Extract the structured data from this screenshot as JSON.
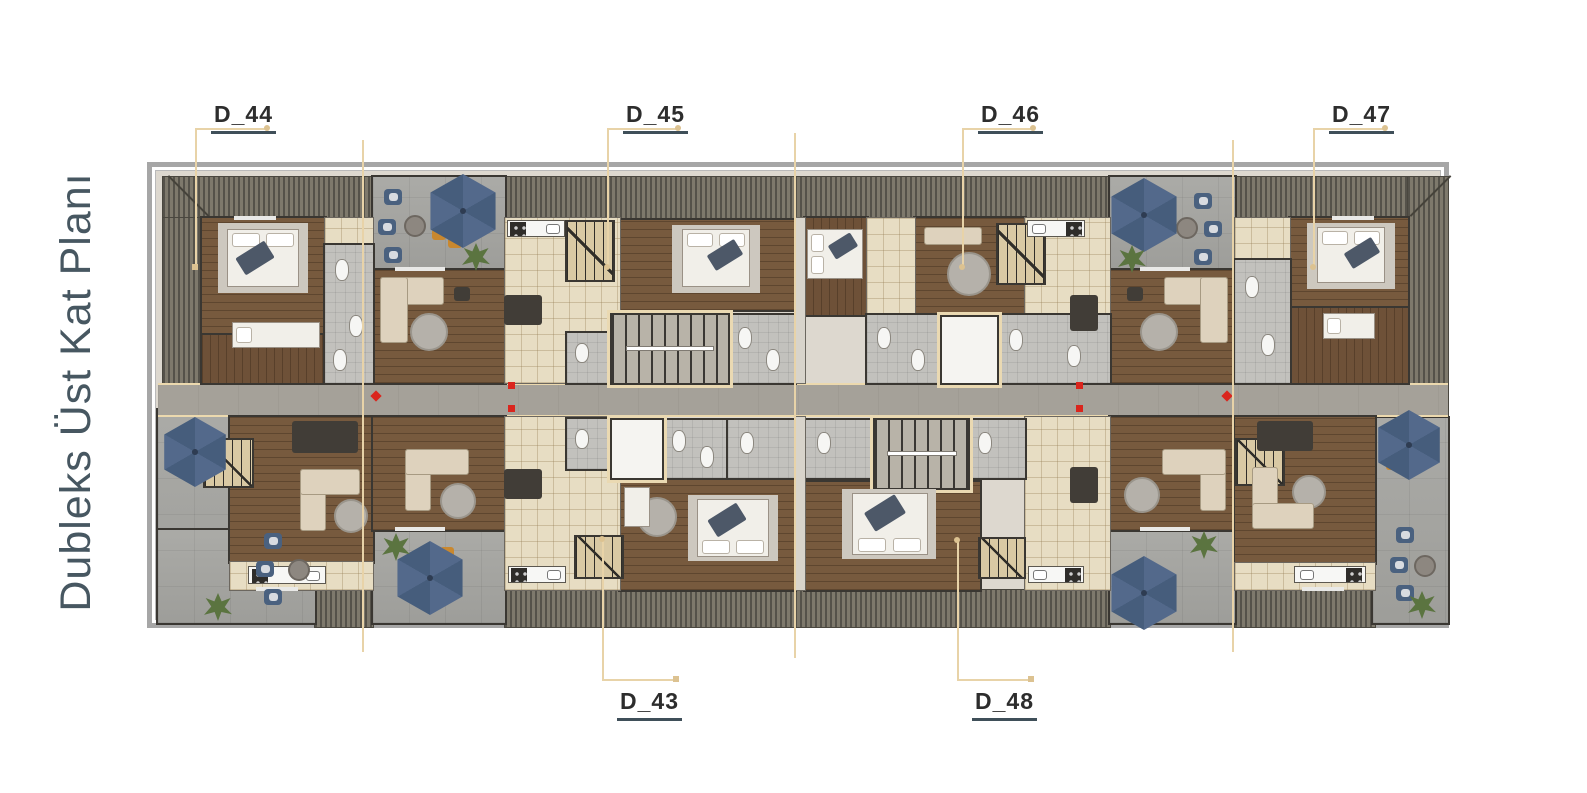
{
  "title": "Dubleks Üst Kat Planı",
  "units": [
    {
      "id": "d44",
      "label": "D_44"
    },
    {
      "id": "d45",
      "label": "D_45"
    },
    {
      "id": "d46",
      "label": "D_46"
    },
    {
      "id": "d47",
      "label": "D_47"
    },
    {
      "id": "d43",
      "label": "D_43"
    },
    {
      "id": "d48",
      "label": "D_48"
    }
  ],
  "colors": {
    "title_text": "#475761",
    "label_text": "#2d2d2d",
    "label_underline": "#3f4f59",
    "leader_line": "#e8d3a8",
    "section_line": "#e8d3a8",
    "marker_red": "#da251d",
    "umbrella_blue": "#4e6788",
    "roof_hatch": "#7e796c",
    "wood_floor": "#775a3e",
    "tile_floor": "#e7ddc3",
    "terrace_concrete": "#a6a6a2",
    "frame_gray": "#a6a6a6"
  },
  "icons": [
    "umbrella-icon",
    "plant-icon",
    "bed-icon",
    "sofa-icon",
    "stove-icon",
    "sink-icon",
    "stairs-icon",
    "elevator-icon"
  ]
}
